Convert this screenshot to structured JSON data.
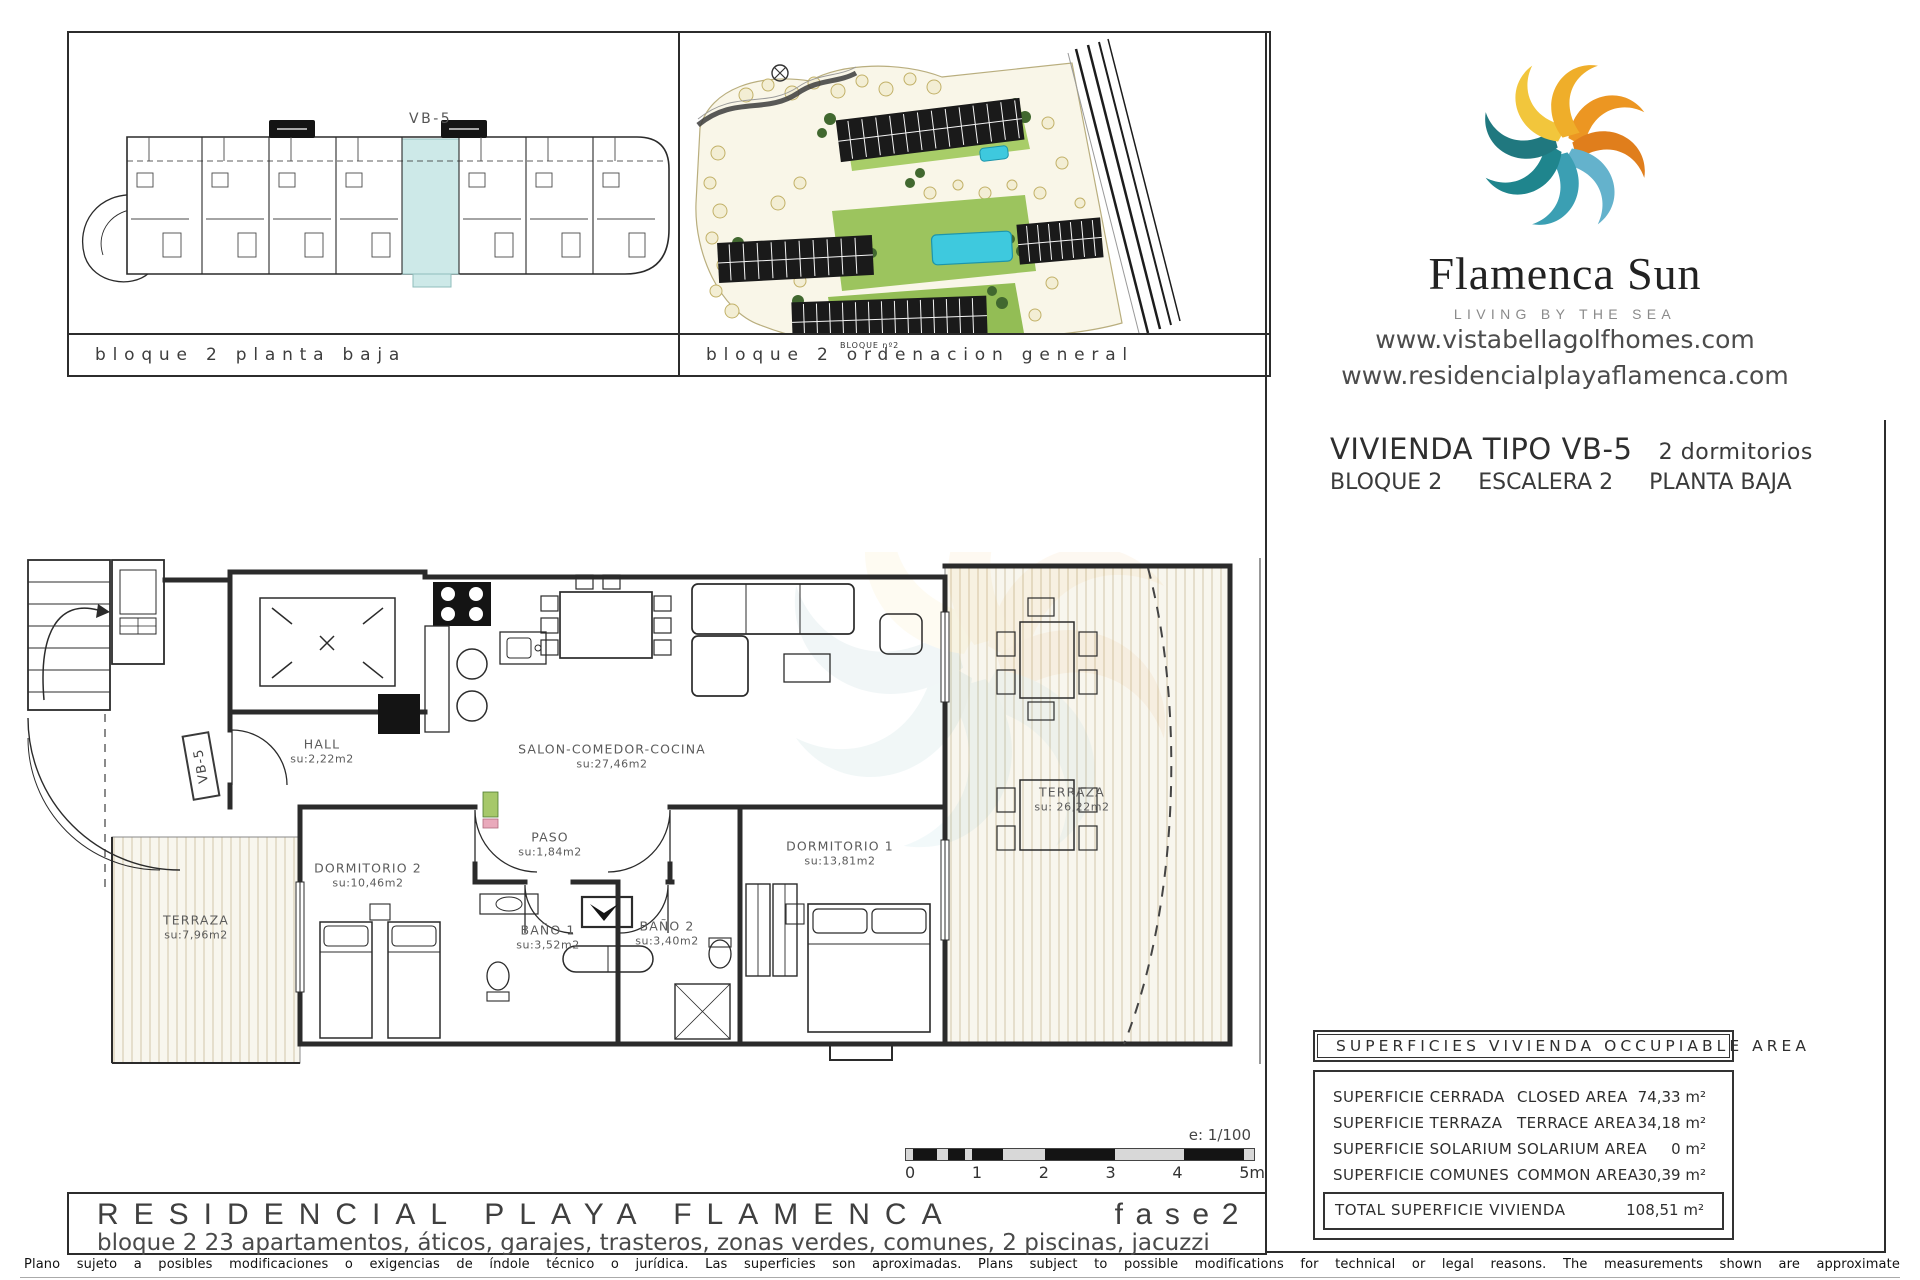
{
  "panel_planta": {
    "caption": "bloque 2 planta baja",
    "unit_label": "VB-5"
  },
  "panel_ordenacion": {
    "caption": "bloque 2 ordenacion general",
    "block_label": "BLOQUE nº2"
  },
  "brand": {
    "name": "Flamenca Sun",
    "tagline": "LIVING BY THE SEA",
    "website1": "www.vistabellagolfhomes.com",
    "website2": "www.residencialplayaflamenca.com"
  },
  "unit": {
    "title": "VIVIENDA TIPO VB-5",
    "bedrooms": "2 dormitorios",
    "block": "BLOQUE 2",
    "stair": "ESCALERA 2",
    "floor": "PLANTA BAJA"
  },
  "plan": {
    "tag": "VB-5",
    "rooms": [
      {
        "name": "HALL",
        "area": "su:2,22m2"
      },
      {
        "name": "SALON-COMEDOR-COCINA",
        "area": "su:27,46m2"
      },
      {
        "name": "PASO",
        "area": "su:1,84m2"
      },
      {
        "name": "DORMITORIO 2",
        "area": "su:10,46m2"
      },
      {
        "name": "DORMITORIO 1",
        "area": "su:13,81m2"
      },
      {
        "name": "BAÑO 1",
        "area": "su:3,52m2"
      },
      {
        "name": "BAÑO 2",
        "area": "su:3,40m2"
      },
      {
        "name": "TERRAZA",
        "area": "su:7,96m2"
      },
      {
        "name": "TERRAZA",
        "area": "su: 26,22m2"
      }
    ]
  },
  "scalebar": {
    "note": "e: 1/100",
    "ticks": [
      "0",
      "1",
      "2",
      "3",
      "4",
      "5m"
    ]
  },
  "titleblock": {
    "title": "RESIDENCIAL PLAYA FLAMENCA",
    "phase": "fase2",
    "subtitle": "bloque 2   23 apartamentos, áticos, garajes, trasteros, zonas verdes, comunes, 2 piscinas, jacuzzi"
  },
  "areas_table": {
    "header": "SUPERFICIES VIVIENDA OCCUPIABLE AREA",
    "rows": [
      {
        "es": "SUPERFICIE CERRADA",
        "en": "CLOSED AREA",
        "value": "74,33 m²"
      },
      {
        "es": "SUPERFICIE TERRAZA",
        "en": "TERRACE AREA",
        "value": "34,18 m²"
      },
      {
        "es": "SUPERFICIE SOLARIUM",
        "en": "SOLARIUM AREA",
        "value": "0 m²"
      },
      {
        "es": "SUPERFICIE COMUNES",
        "en": "COMMON AREA",
        "value": "30,39 m²"
      }
    ],
    "total": {
      "label": "TOTAL SUPERFICIE VIVIENDA",
      "value": "108,51 m²"
    }
  },
  "disclaimer": "Plano sujeto a posibles modificaciones o exigencias de índole técnico o jurídica. Las superficies son aproximadas. Plans subject to possible modifications for technical or legal reasons. The measurements shown are approximate",
  "colors": {
    "highlight_unit": "#CDE9E8",
    "pool": "#3EC9DE",
    "logo_orange": "#E8871E",
    "logo_yellow": "#F2C63C",
    "logo_teal": "#1F858D"
  }
}
